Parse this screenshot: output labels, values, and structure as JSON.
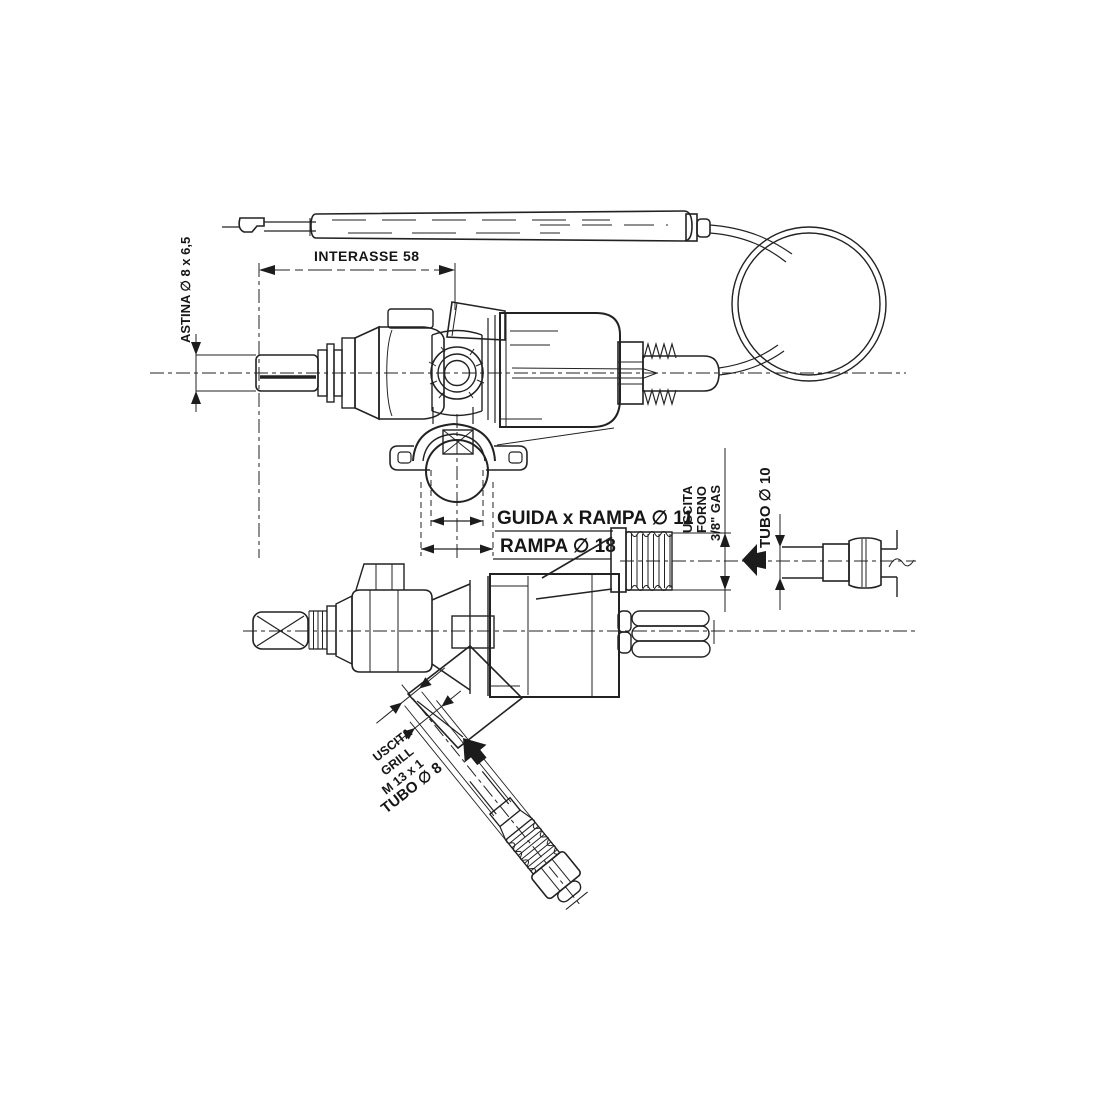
{
  "colors": {
    "background": "#ffffff",
    "ink": "#222222"
  },
  "drawing": {
    "labels": {
      "astina": "ASTINA ∅ 8 x 6,5",
      "interasse": "INTERASSE 58",
      "guida_rampa": "GUIDA x RAMPA ∅ 11",
      "rampa": "RAMPA ∅ 18",
      "uscita_forno_line1": "USCITA",
      "uscita_forno_line2": "FORNO",
      "uscita_forno_line3": "3/8\" GAS",
      "tubo_forno": "TUBO ∅ 10",
      "uscita_grill_line1": "USCITA",
      "uscita_grill_line2": "GRILL",
      "uscita_grill_line3": "M 13 x 1",
      "tubo_grill": "TUBO ∅ 8"
    }
  }
}
